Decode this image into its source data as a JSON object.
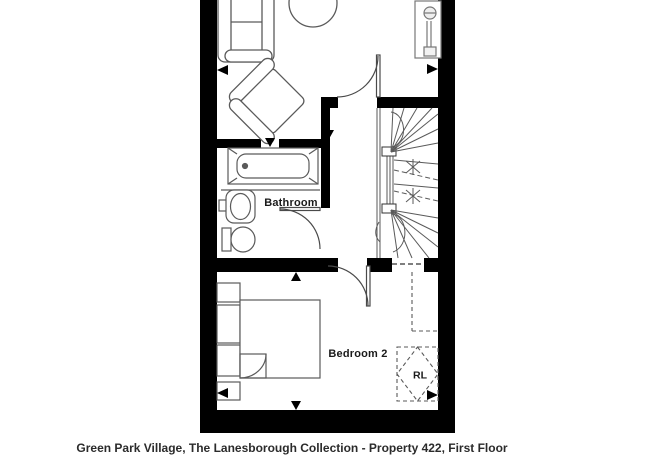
{
  "page": {
    "caption": "Green Park Village, The Lanesborough Collection - Property 422, First Floor"
  },
  "floorplan": {
    "labels": {
      "bathroom": "Bathroom",
      "bedroom2": "Bedroom 2",
      "rooflight": "RL"
    },
    "features": [
      "sofa",
      "coffee-table",
      "armchair",
      "radiator",
      "landing-door",
      "winder-staircase",
      "bathtub",
      "washbasin",
      "toilet",
      "bathroom-door",
      "double-bed",
      "bed-fold-corner",
      "built-in-units",
      "bedroom-door",
      "rooflight-zone",
      "restricted-headroom-lines",
      "dimension-markers"
    ],
    "colors": {
      "walls": "#000000",
      "fixtures": "#5a5a5a",
      "doors": "#4a4a4a",
      "background": "#ffffff",
      "label_text": "#1a1a1a"
    }
  }
}
